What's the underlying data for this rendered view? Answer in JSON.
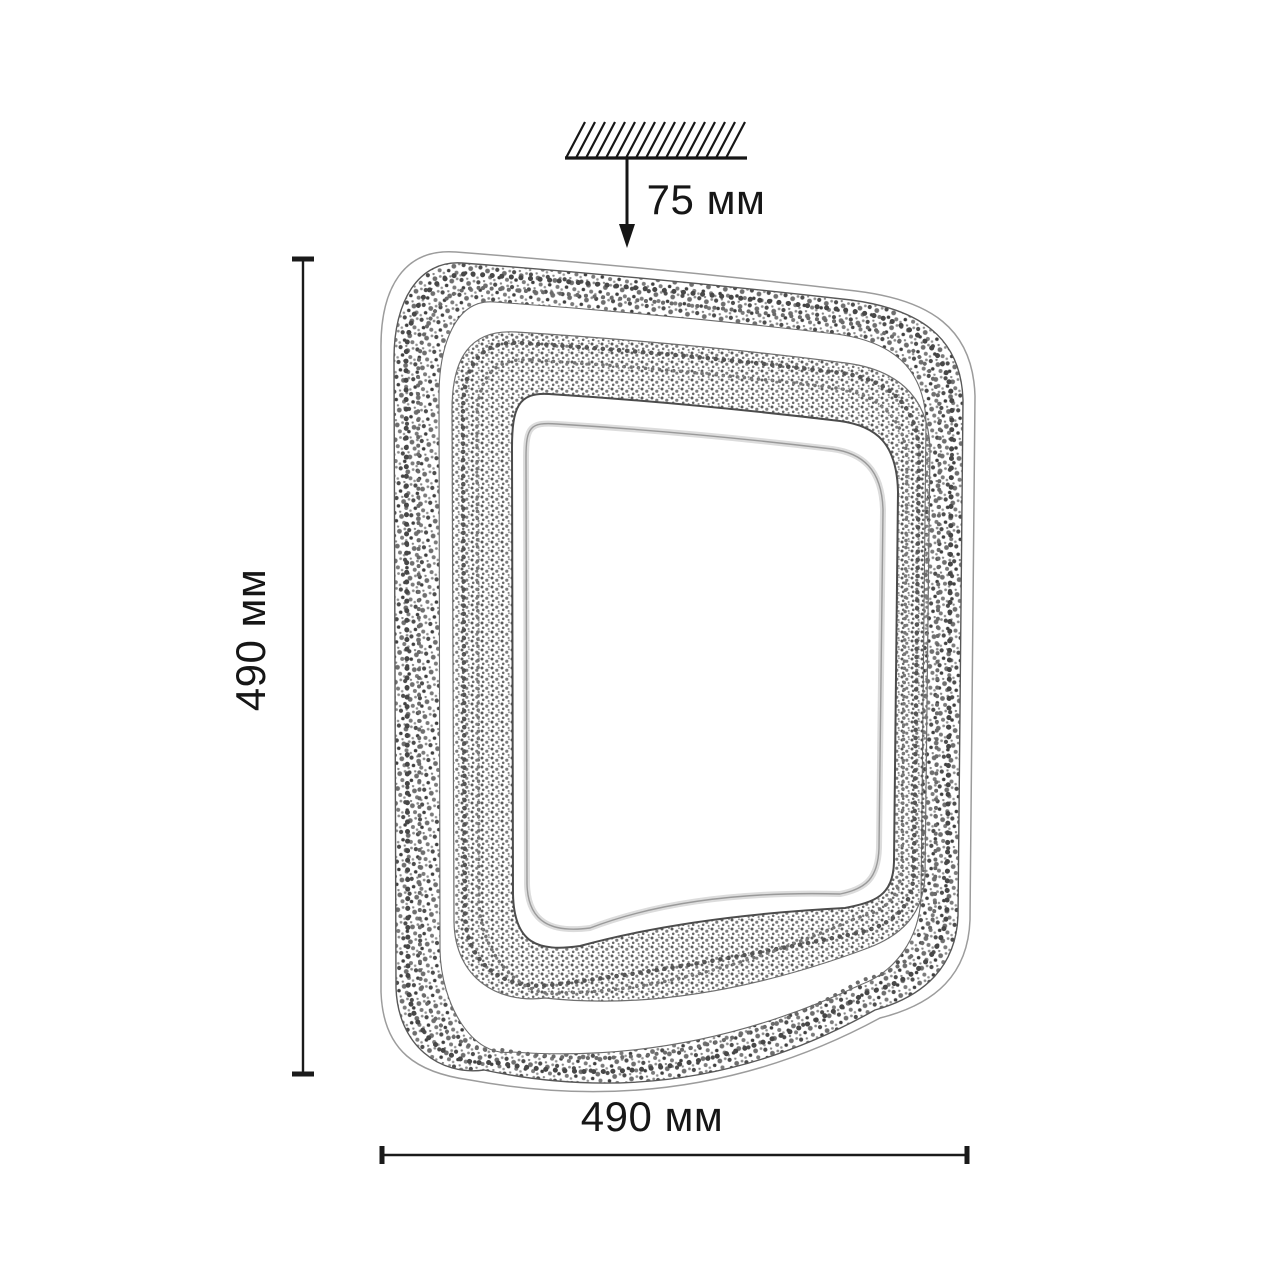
{
  "diagram": {
    "type": "product-dimension-drawing",
    "object": "square-crystal-led-ceiling-light",
    "labels": {
      "ceiling_offset": "75 мм",
      "height": "490 мм",
      "width": "490 мм"
    },
    "colors": {
      "background": "#ffffff",
      "dimension_line": "#1a1a1a",
      "drawing_line": "#555555"
    }
  }
}
